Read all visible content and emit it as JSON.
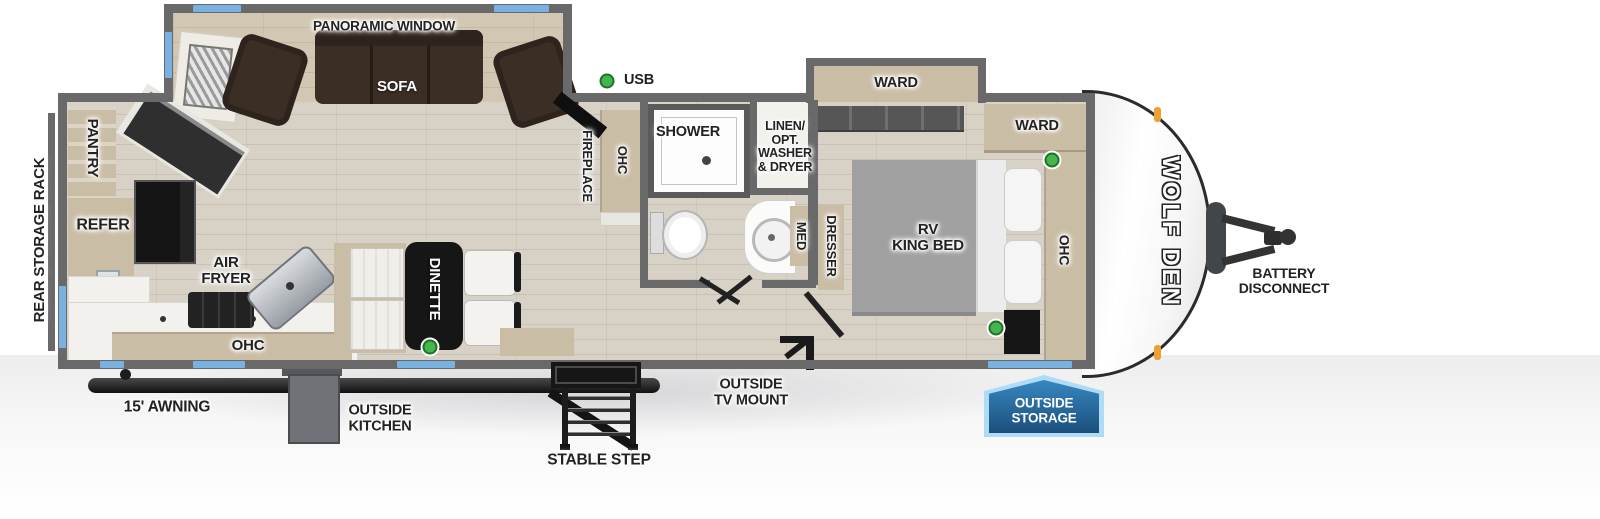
{
  "floorplan": {
    "brand_logo": "WOLF DEN",
    "exterior": {
      "rear_storage_rack": "REAR STORAGE RACK",
      "awning": "15' AWNING",
      "outside_kitchen_l1": "OUTSIDE",
      "outside_kitchen_l2": "KITCHEN",
      "stable_step": "STABLE STEP",
      "outside_tv_mount_l1": "OUTSIDE",
      "outside_tv_mount_l2": "TV MOUNT",
      "outside_storage_l1": "OUTSIDE",
      "outside_storage_l2": "STORAGE",
      "battery_l1": "BATTERY",
      "battery_l2": "DISCONNECT"
    },
    "living": {
      "panoramic_window": "PANORAMIC WINDOW",
      "sofa": "SOFA",
      "usb": "USB",
      "fireplace": "FIREPLACE",
      "ohc": "OHC",
      "dinette": "DINETTE"
    },
    "kitchen": {
      "pantry": "PANTRY",
      "refer": "REFER",
      "air_fryer_l1": "AIR",
      "air_fryer_l2": "FRYER",
      "ohc": "OHC"
    },
    "bathroom": {
      "shower": "SHOWER",
      "linen_l1": "LINEN/",
      "linen_l2": "OPT.",
      "linen_l3": "WASHER",
      "linen_l4": "& DRYER",
      "med": "MED"
    },
    "bedroom": {
      "ward_slide": "WARD",
      "ward_corner": "WARD",
      "bed_l1": "RV",
      "bed_l2": "KING BED",
      "ohc": "OHC",
      "dresser": "DRESSER"
    },
    "colors": {
      "wall": "#696969",
      "window": "#79b1e0",
      "storage_badge": "#1c4f7c",
      "usb_indicator": "#46b54d",
      "floor": "#d8d1c6"
    }
  }
}
